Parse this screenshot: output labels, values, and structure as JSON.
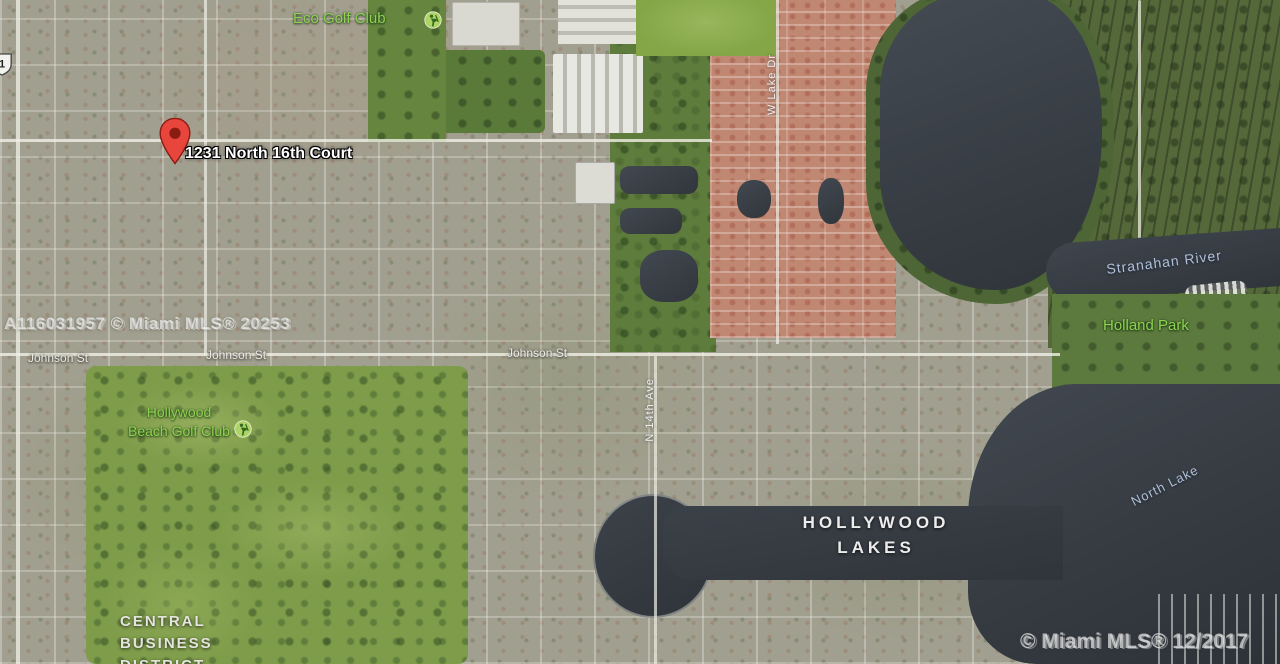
{
  "marker": {
    "label": "1231 North 16th Court"
  },
  "labels": {
    "eco_golf_club": "Eco Golf Club",
    "johnson_st": "Johnson St",
    "hollywood_beach_golf_club_line1": "Hollywood",
    "hollywood_beach_golf_club_line2": "Beach Golf Club",
    "hollywood_lakes_line1": "HOLLYWOOD",
    "hollywood_lakes_line2": "LAKES",
    "central_business_district_line1": "CENTRAL",
    "central_business_district_line2": "BUSINESS",
    "central_business_district_line3": "DISTRICT",
    "stranahan_river": "Stranahan River",
    "holland_park": "Holland Park",
    "north_lake": "North Lake",
    "w_lake_dr": "W Lake Dr",
    "n_14th_ave": "N 14th Ave",
    "route_shield_number": "1"
  },
  "watermarks": {
    "left": "A116031957 © Miami MLS® 20253",
    "right": "© Miami MLS® 12/2017"
  },
  "icons": {
    "pin": "red-map-pin-icon",
    "golf": "golf-club-icon",
    "shield": "us-route-1-shield-icon"
  },
  "colors": {
    "water_dark": "#33383e",
    "marsh_green": "#55683a",
    "golf_green": "#7e9c4a",
    "townhome_salmon": "#c08772",
    "park_label_green": "#8ed34f",
    "water_label_blue": "#b0c1d8",
    "pin_red": "#e8453c"
  }
}
